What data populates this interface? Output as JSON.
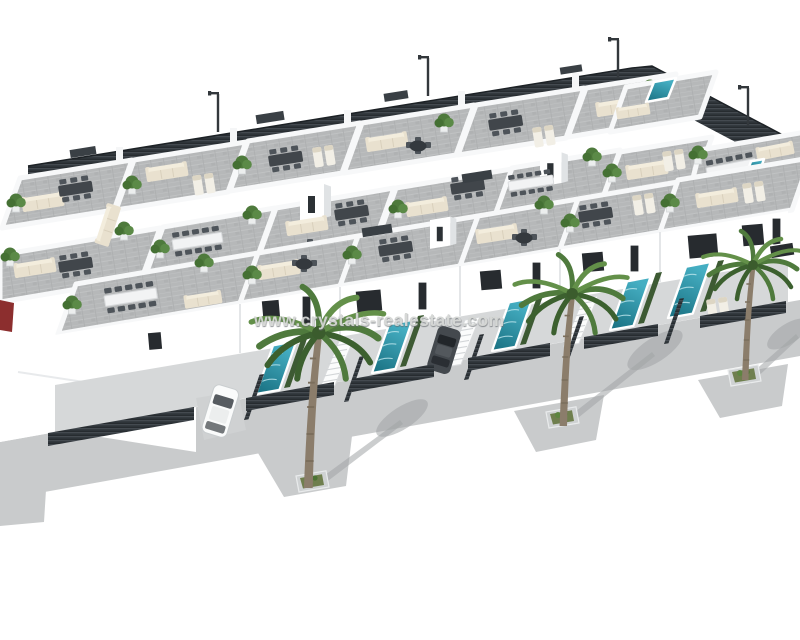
{
  "image": {
    "type": "3d-architectural-render",
    "description": "Aerial 3D render of a modern white residential development: rows of villas with grey rooftop solarium terraces, outdoor lounge and dining furniture, private teal pools, dark slatted fences, street lamps and a palm-lined grey sidewalk on a pure white background."
  },
  "watermark": {
    "text": "www.crystals-realestate.com"
  },
  "palette": {
    "background": "#ffffff",
    "wall_lit": "#ffffff",
    "wall_shade": "#eceeef",
    "wall_dark": "#e0e3e5",
    "parapet": "#f7f8f9",
    "terrace_floor": "#b6b8b9",
    "glass": "#272b2f",
    "fence_dark": "#343a3f",
    "pool_teal": "#186f80",
    "pool_light": "#45aec2",
    "pavement": "#c9cbcc",
    "pavement_shadow": "#9fa3a5",
    "hedge": "#3d5a33",
    "palm_green": "#4f7a3d",
    "palm_trunk": "#8b7d6b",
    "sofa": "#e9e1cf",
    "watermark": "#d4d6d4"
  },
  "scene": {
    "palm_trees_street": 3,
    "street_lamps": 4,
    "private_pools": 5,
    "rooftop_pools": 1,
    "rooftop_spas": 1,
    "cars": [
      "white",
      "dark-gray",
      "red (edge sliver)"
    ]
  }
}
